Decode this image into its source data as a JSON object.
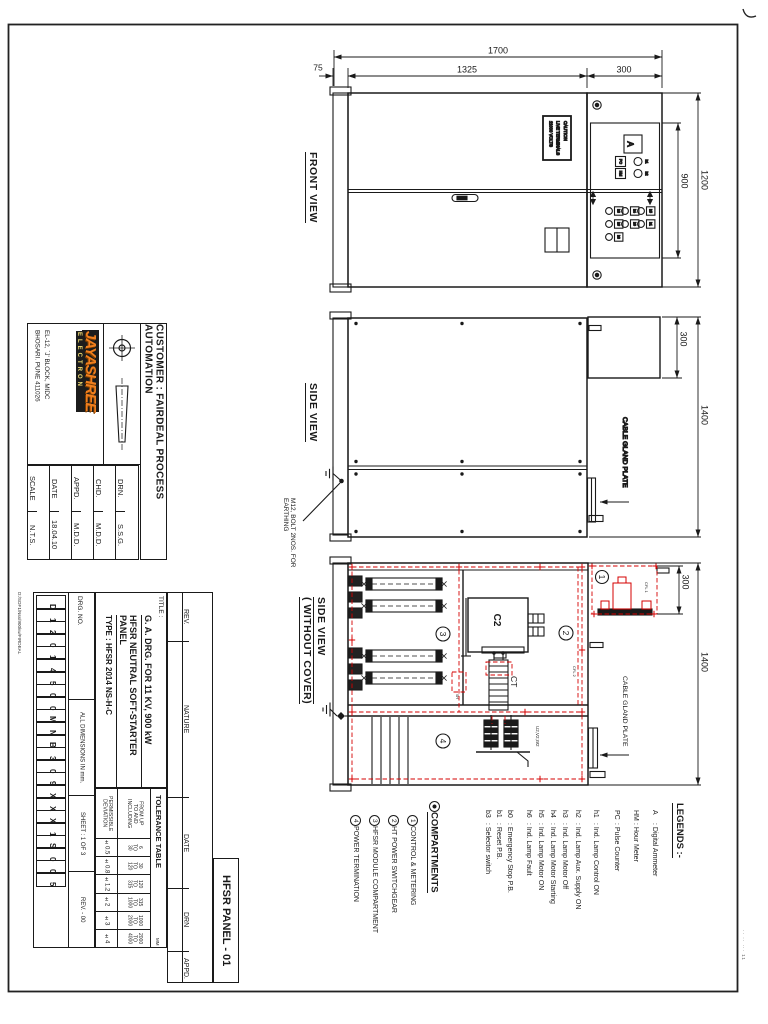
{
  "sheet": {
    "panel_name": "HFSR PANEL - 01",
    "edge_stamp": "·· ·· ··· 11",
    "file_path": "D:/SOF1/Nss/900kw/FIRDEAL"
  },
  "company": {
    "name": "JAYASHREE",
    "tagline": "ELECTRON",
    "address1": "EL-12, `J' BLOCK, MIDC",
    "address2": "BHOSARI. PUNE 411026"
  },
  "customer": "CUSTOMER :  FAIRDEAL PROCESS AUTOMATION",
  "approval": {
    "drn_label": "DRN.",
    "drn": "S.S.G.",
    "chd_label": "CHD.",
    "chd": "M.D.D.",
    "appd_label": "APPD.",
    "appd": "M.D.D.",
    "date_label": "DATE",
    "date": "18.04.10",
    "scale_label": "SCALE",
    "scale": "N.T.S."
  },
  "drg": {
    "label": "DRG. NO.",
    "boxes": [
      "D",
      "1",
      "2",
      "0",
      "1",
      "4",
      "5",
      "0",
      "0",
      "M",
      "N",
      "B",
      "3",
      "0",
      "9",
      "X",
      "X",
      "X",
      "1",
      "S",
      "0",
      "0",
      "5"
    ],
    "all_dims": "ALL DIMENSIONS IN mm.",
    "sheet_no": "SHEET : 1 OF 3",
    "rev": "REV. - 00"
  },
  "title": {
    "label": "TITLE :",
    "line1": "G. A. DRG. FOR 11 KV, 900 kW",
    "line2": "HFSR NEUTRAL SOFT-STARTER PANEL",
    "line3": "TYPE : HFSR 2014 NS-H-C"
  },
  "tolerance": {
    "heading": "TOLERANCE TABLE",
    "unit": "MM",
    "range_label": "FROM UP\nTO AND\nINCLUDING",
    "dev_label": "PERMISSIBLE\nDEVIATION",
    "ranges": [
      "6\nTO\n30",
      "30\nTO\n120",
      "120\nTO\n315",
      "315\nTO\n1000",
      "1000\nTO\n2000",
      "2000\nTO\n4000"
    ],
    "devs": [
      "±0.5",
      "±0.8",
      "±1.2",
      "±2",
      "±3",
      "±4"
    ]
  },
  "revision": {
    "rev": "REV.",
    "nature": "NATURE",
    "date": "DATE",
    "drn": "DRN",
    "appd": "APPD."
  },
  "views": {
    "front": {
      "label": "FRONT VIEW",
      "dim_total_w": "1700",
      "dim_door_w": "1325",
      "dim_instr_w": "300",
      "dim_base_w": "75",
      "dim_door_h": "900",
      "dim_total_h": "1200",
      "caution1": "CAUTION",
      "caution2": "LIVE TERMINALS",
      "caution3": "11000 VOLTS",
      "ammeter": "A",
      "pc": "PC",
      "hm": "HM",
      "lamps": [
        "h1",
        "h2",
        "h3",
        "h4",
        "h5",
        "h6",
        "b0",
        "b1",
        "b3"
      ]
    },
    "side": {
      "label": "SIDE VIEW",
      "dim_top": "300",
      "dim_depth": "1400",
      "gland": "CABLE GLAND PLATE",
      "earth1": "M12, BOLT 2NOS. FOR",
      "earth2": "EARTHING"
    },
    "open": {
      "label1": "SIDE VIEW",
      "label2": "( WITHOUT COVER)",
      "dim_top": "300",
      "dim_depth": "1400",
      "gland": "CABLE GLAND PLATE",
      "c2": "C2",
      "ct": "CT",
      "cfl1": "CFL 1",
      "cfl2": "CFL 2",
      "sh": "SH",
      "uvw": "U2,V2,W2",
      "comp1": "1",
      "comp2": "2",
      "comp3": "3",
      "comp4": "4"
    }
  },
  "legends": {
    "heading": "LEGENDS :-",
    "items": [
      {
        "key": "A",
        "desc": ": Digital Ammeter"
      },
      {
        "key": "HM",
        "desc": ": Hour Meter"
      },
      {
        "key": "PC",
        "desc": ": Pulse Counter"
      },
      {
        "key": "h1",
        "desc": ": Ind. Lamp Control ON"
      },
      {
        "key": "h2",
        "desc": ": Ind. Lamp Aux. Supply ON"
      },
      {
        "key": "h3",
        "desc": ": Ind. Lamp Motor Off"
      },
      {
        "key": "h4",
        "desc": ": Ind. Lamp Motor Starting"
      },
      {
        "key": "h5",
        "desc": ": Ind. Lamp Motor ON"
      },
      {
        "key": "h6",
        "desc": ": Ind. Lamp Fault"
      },
      {
        "key": "b0",
        "desc": ": Emergency Stop P.B."
      },
      {
        "key": "b1",
        "desc": ": Reset P.B."
      },
      {
        "key": "b3",
        "desc": ": Selector switch"
      }
    ]
  },
  "compartments": {
    "heading": "COMPARTMENTS",
    "items": [
      {
        "num": "1",
        "desc": "CONTROL & METERING"
      },
      {
        "num": "2",
        "desc": "HT POWER SWITCHGEAR"
      },
      {
        "num": "3",
        "desc": "HFSR MODULE COMPARTMENT"
      },
      {
        "num": "4",
        "desc": "POWER TERMINATION"
      }
    ]
  }
}
